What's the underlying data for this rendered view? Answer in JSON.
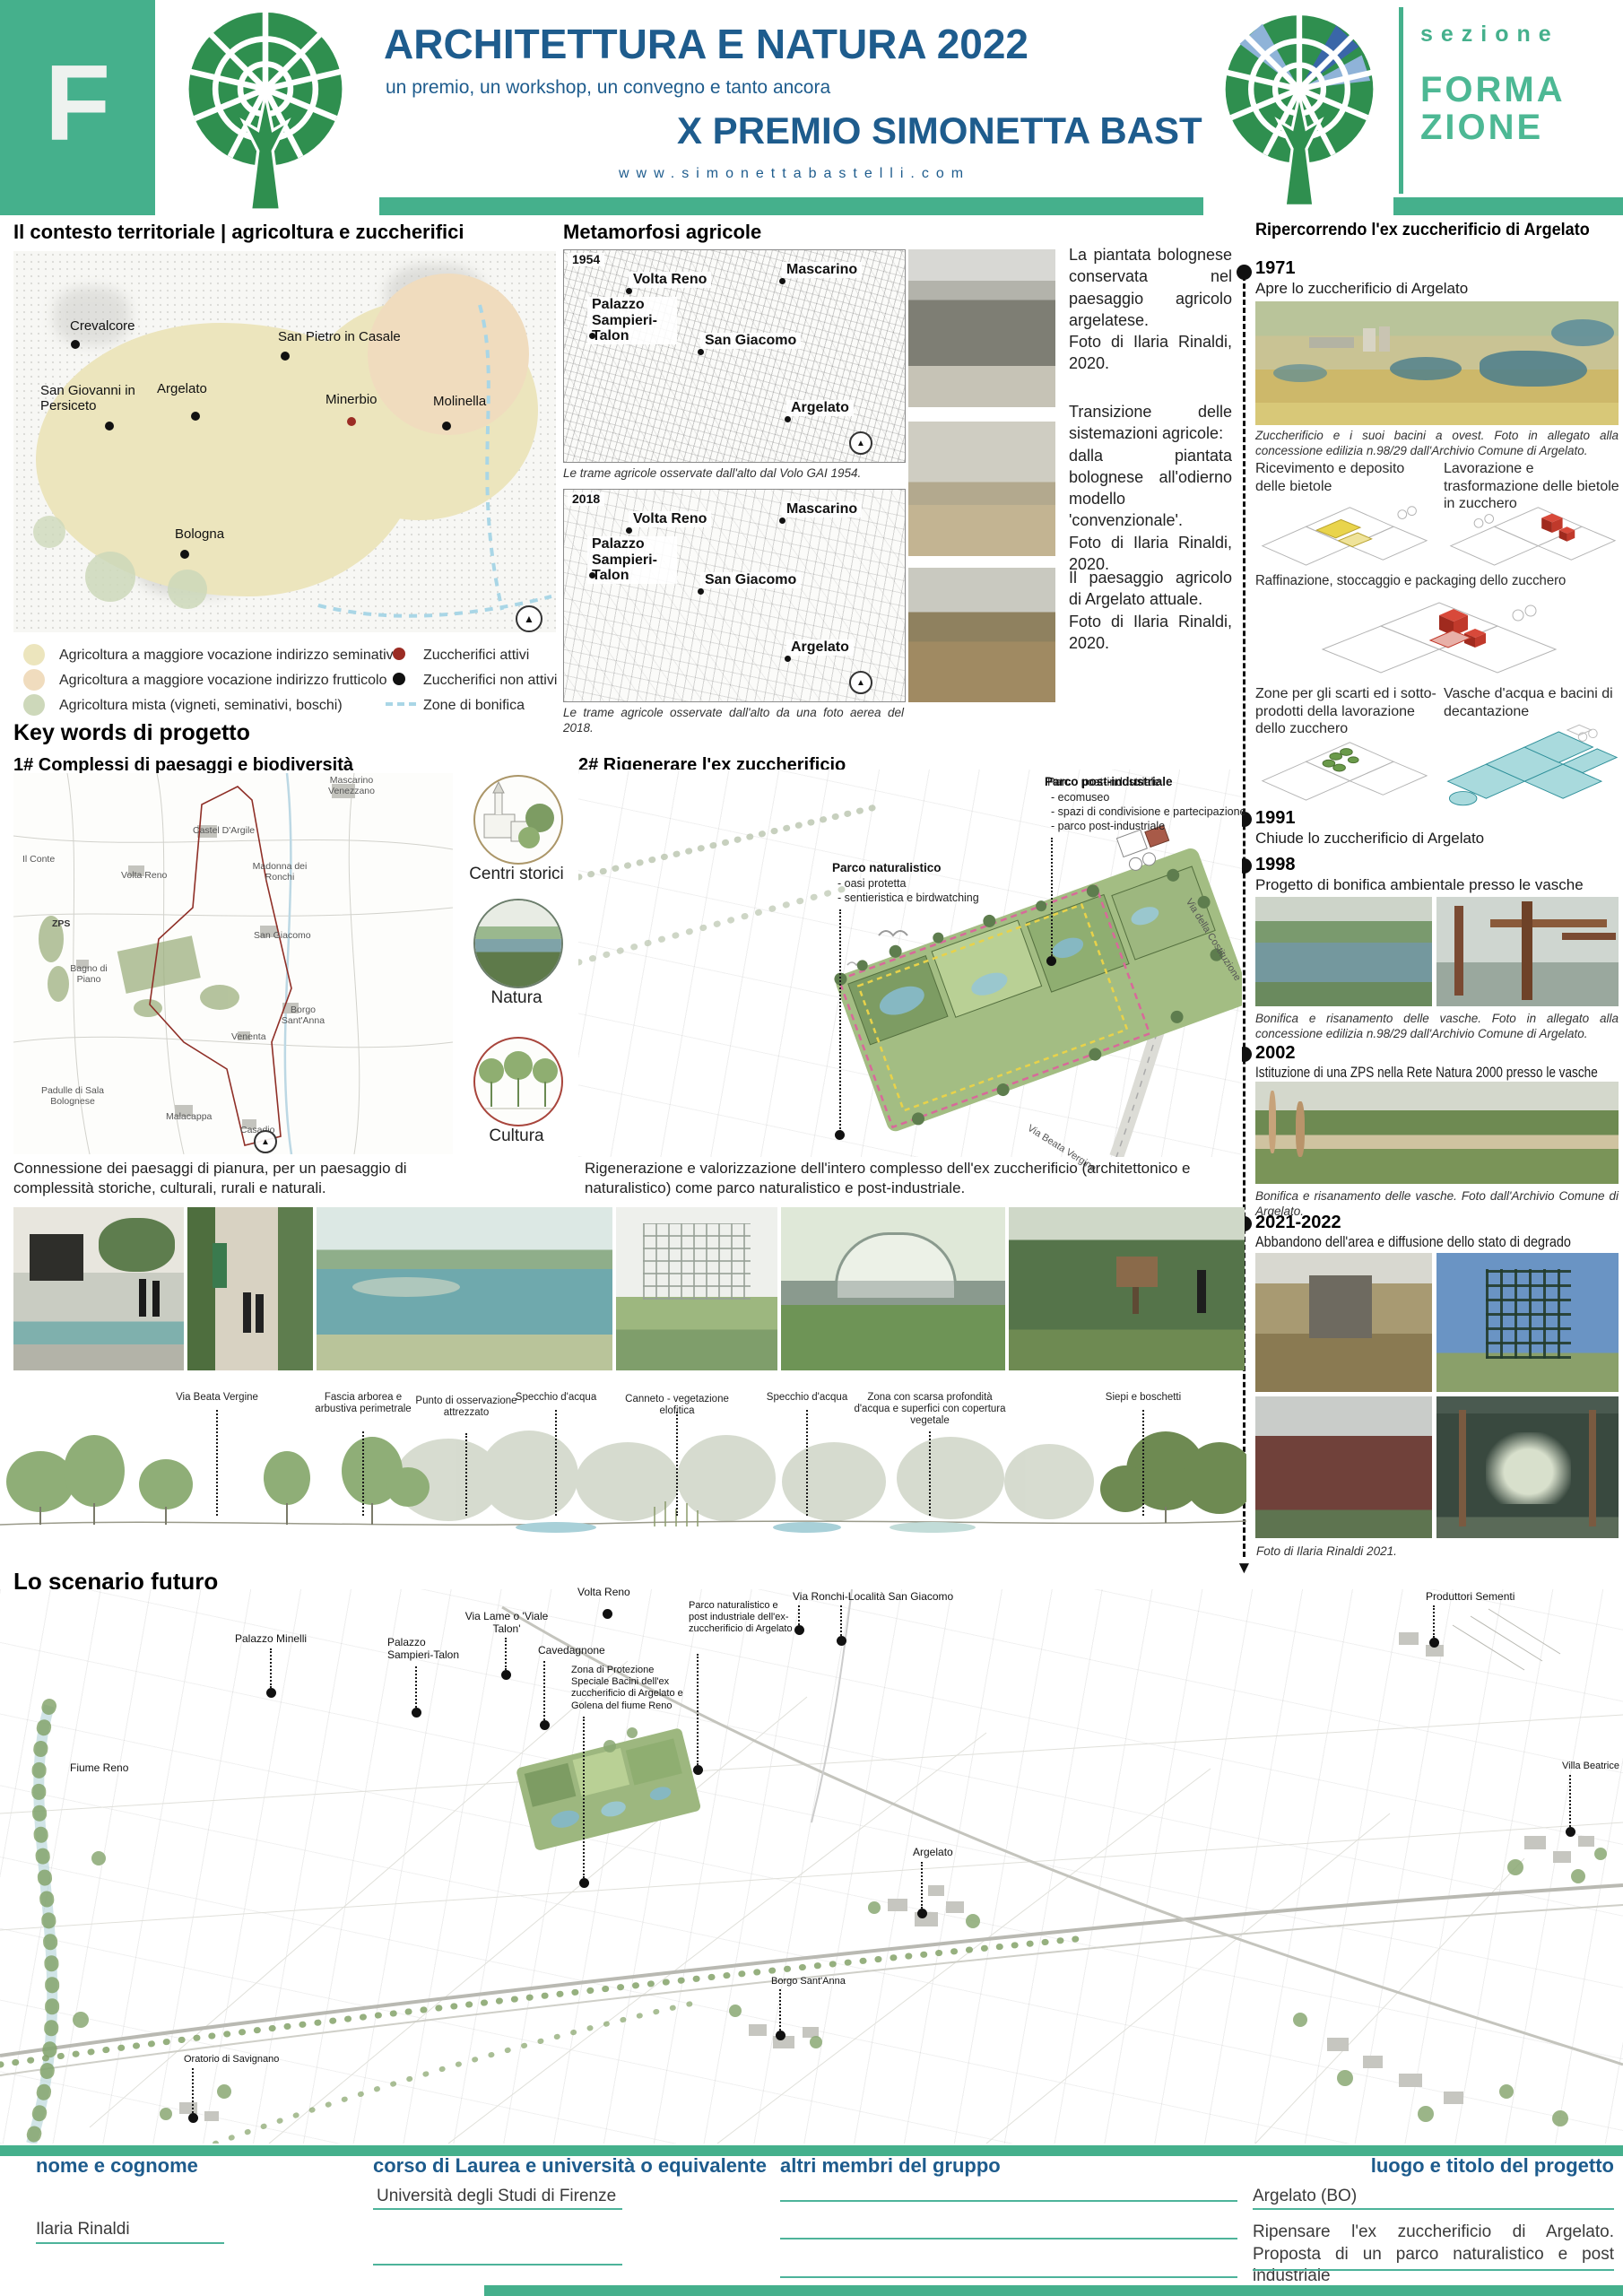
{
  "header": {
    "section_letter": "F",
    "title": "ARCHITETTURA E NATURA 2022",
    "subtitle": "un premio, un workshop, un convegno e tanto ancora",
    "prize": "X PREMIO SIMONETTA BASTELLI",
    "website": "www.simonettabastelli.com",
    "section_label": "sezione",
    "section_line1": "FORMA",
    "section_line2": "ZIONE"
  },
  "colors": {
    "brand_green": "#45b08c",
    "logo_green": "#2f8f4f",
    "dark_blue": "#1d5b8c",
    "legend_seminativo": "#ece5bd",
    "legend_frutticolo": "#f0dcbe",
    "legend_mista": "#cdd8ba",
    "zuccherifici_attivi": "#9b2c24",
    "zone_bonifica": "#a9d6e6",
    "vasche_teal": "#a9dadd"
  },
  "territorio": {
    "heading": "Il contesto territoriale | agricoltura e zuccherifici",
    "cities": [
      {
        "name": "Crevalcore",
        "dot": "black"
      },
      {
        "name": "San Pietro in Casale",
        "dot": "black"
      },
      {
        "name": "San Giovanni in Persiceto",
        "dot": "black"
      },
      {
        "name": "Argelato",
        "dot": "black"
      },
      {
        "name": "Minerbio",
        "dot": "red"
      },
      {
        "name": "Molinella",
        "dot": "black"
      },
      {
        "name": "Bologna",
        "dot": "black"
      }
    ],
    "legend": [
      {
        "label": "Agricoltura a maggiore vocazione indirizzo seminativo",
        "swatch": "#ece5bd"
      },
      {
        "label": "Agricoltura a maggiore vocazione indirizzo frutticolo",
        "swatch": "#f0dcbe"
      },
      {
        "label": "Agricoltura mista (vigneti, seminativi, boschi)",
        "swatch": "#cdd8ba"
      },
      {
        "label": "Zuccherifici attivi",
        "swatch": "#9b2c24"
      },
      {
        "label": "Zuccherifici non attivi",
        "swatch": "#111111"
      },
      {
        "label": "Zone di bonifica",
        "swatch": "#a9d6e6"
      }
    ]
  },
  "metamorfosi": {
    "heading": "Metamorfosi agricole",
    "maps": [
      {
        "year": "1954",
        "caption": "Le trame agricole osservate dall'alto dal Volo GAI 1954.",
        "places": [
          "Volta Reno",
          "Mascarino",
          "Palazzo Sampieri-Talon",
          "San Giacomo",
          "Argelato"
        ]
      },
      {
        "year": "2018",
        "caption": "Le trame agricole osservate dall'alto da una foto aerea del 2018.",
        "places": [
          "Volta Reno",
          "Mascarino",
          "Palazzo Sampieri-Talon",
          "San Giacomo",
          "Argelato"
        ]
      }
    ]
  },
  "foto_note": [
    "La piantata bolognese conservata nel paesaggio agricolo argelatese.\nFoto di Ilaria Rinaldi, 2020.",
    "Transizione delle sistemazioni agricole:\ndalla piantata bolognese all'odierno modello 'convenzionale'.\nFoto di Ilaria Rinaldi, 2020.",
    "Il paesaggio agricolo di Argelato attuale.\nFoto di Ilaria Rinaldi, 2020."
  ],
  "timeline": {
    "heading": "Ripercorrendo l'ex zuccherificio di Argelato",
    "e1971": {
      "year": "1971",
      "text": "Apre lo zuccherificio di Argelato",
      "caption": "Zuccherificio e i suoi bacini a ovest. Foto in allegato alla concessione edilizia n.98/29 dall'Archivio Comune di Argelato."
    },
    "diagrams": [
      "Ricevimento e deposito delle bietole",
      "Lavorazione e trasformazione delle bietole in zucchero",
      "Raffinazione, stoccaggio e packaging dello zucchero",
      "Zone per gli scarti ed i sotto-prodotti della lavorazione dello zucchero",
      "Vasche d'acqua e bacini di decantazione"
    ],
    "e1991": {
      "year": "1991",
      "text": "Chiude lo zuccherificio di Argelato"
    },
    "e1998": {
      "year": "1998",
      "text": "Progetto di bonifica ambientale presso le vasche",
      "caption": "Bonifica e risanamento delle vasche. Foto in allegato alla concessione edilizia n.98/29 dall'Archivio Comune di Argelato."
    },
    "e2002": {
      "year": "2002",
      "text": "Istituzione di una ZPS nella Rete Natura 2000 presso le vasche",
      "caption": "Bonifica e risanamento delle vasche. Foto dall'Archivio Comune di Argelato."
    },
    "e2021": {
      "year": "2021-2022",
      "text": "Abbandono dell'area e diffusione dello stato di degrado",
      "caption": "Foto di Ilaria Rinaldi 2021."
    }
  },
  "keywords": {
    "heading": "Key words di progetto",
    "p1": {
      "heading": "1# Complessi di paesaggi e biodiversità",
      "caption": "Connessione dei paesaggi di pianura, per un paesaggio di complessità storiche, culturali, rurali e naturali.",
      "places": [
        "Mascarino Venezzano",
        "Castel D'Argile",
        "Il Conte",
        "Volta Reno",
        "Madonna dei Ronchi",
        "ZPS",
        "San Giacomo",
        "Bagno di Piano",
        "Borgo Sant'Anna",
        "Venenta",
        "Padulle di Sala Bolognese",
        "Malacappa",
        "Casadio"
      ],
      "circles": [
        "Centri storici",
        "Natura",
        "Cultura"
      ]
    },
    "p2": {
      "heading": "2# Rigenerare l'ex zuccherificio",
      "caption": "Rigenerazione e valorizzazione dell'intero complesso dell'ex zuccherificio (architettonico e naturalistico) come parco naturalistico e post-industriale.",
      "ann1_title": "Parco naturalistico",
      "ann1_items": [
        "- oasi protetta",
        "- sentieristica e birdwatching"
      ],
      "ann2_title": "Parco post-industriale",
      "ann2_items": [
        "- ecomuseo",
        "- spazi di condivisione e partecipazione",
        "- parco post-industriale"
      ],
      "roads": [
        "Via della Costituzione",
        "Via Beata Vergine"
      ]
    }
  },
  "profilo": {
    "labels": [
      "Via Beata Vergine",
      "Fascia arborea e arbustiva perimetrale",
      "Punto di osservazione attrezzato",
      "Specchio d'acqua",
      "Canneto - vegetazione elofitica",
      "Specchio d'acqua",
      "Zona con scarsa profondità d'acqua e superfici con copertura vegetale",
      "Siepi e boschetti"
    ]
  },
  "scenario": {
    "heading": "Lo scenario futuro",
    "labels": [
      "Palazzo Minelli",
      "Palazzo Sampieri-Talon",
      "Via Lame o 'Viale Talon'",
      "Cavedagnone",
      "Volta Reno",
      "Zona di Protezione Speciale Bacini dell'ex zuccherificio di Argelato e Golena del fiume Reno",
      "Parco naturalistico e post industriale dell'ex-zuccherificio di Argelato",
      "Via Ronchi-Località San Giacomo",
      "Produttori Sementi",
      "Villa Beatrice",
      "Argelato",
      "Borgo Sant'Anna",
      "Fiume Reno",
      "Oratorio di Savignano"
    ]
  },
  "footer": {
    "f1_label": "nome e cognome",
    "f1_value": "Ilaria Rinaldi",
    "f2_label": "corso di Laurea e università o equivalente",
    "f2_value": "Università degli Studi di Firenze",
    "f3_label": "altri membri del gruppo",
    "f4_label": "luogo e titolo del progetto",
    "f4_value_place": "Argelato (BO)",
    "f4_value_title": "Ripensare l'ex zuccherificio di Argelato. Proposta di un parco naturalistico e post industriale"
  }
}
